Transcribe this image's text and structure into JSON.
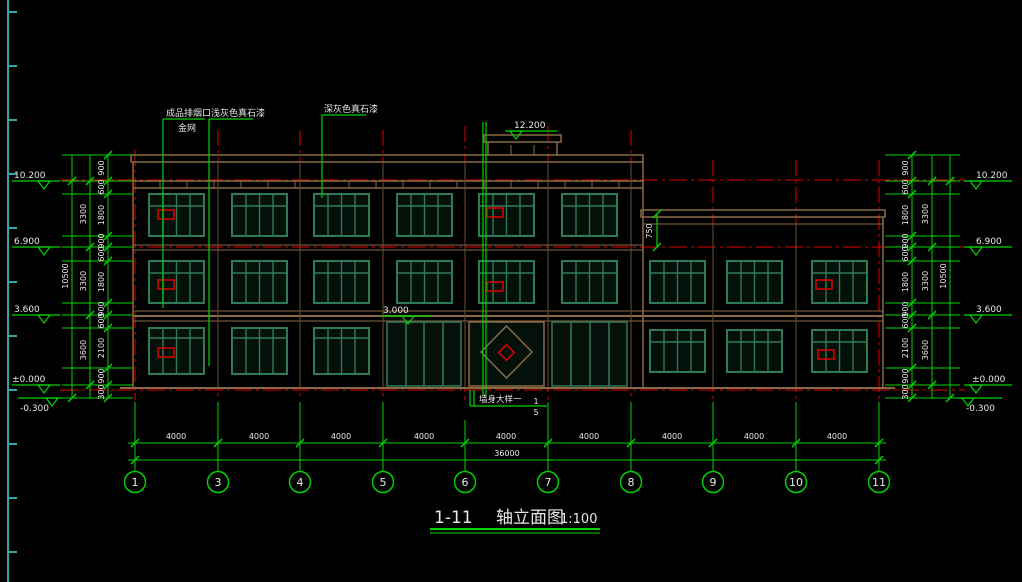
{
  "callouts": {
    "c1_line1": "成品排烟口",
    "c1_line2": "金网",
    "c2": "浅灰色真石漆",
    "c3": "深灰色真石漆"
  },
  "markers": {
    "bulkhead_top": "12.200",
    "canopy": "3.000",
    "levels": [
      "10.200",
      "6.900",
      "3.600",
      "±0.000",
      "-0.300"
    ]
  },
  "dims": {
    "inner": [
      "900",
      "600",
      "1800",
      "900",
      "600",
      "1800",
      "900",
      "600",
      "2100",
      "900",
      "300"
    ],
    "mid": [
      "3300",
      "3300",
      "3600"
    ],
    "total": "10500",
    "wing_parapet": "750"
  },
  "axis_dims": {
    "bays": [
      "4000",
      "4000",
      "4000",
      "4000",
      "4000",
      "4000",
      "4000",
      "4000",
      "4000"
    ],
    "total": "36000"
  },
  "axes": [
    "1",
    "3",
    "4",
    "5",
    "6",
    "7",
    "8",
    "9",
    "10",
    "11"
  ],
  "detail": {
    "label": "墙身大样一",
    "bubble_top": "1",
    "bubble_bottom": "5"
  },
  "title": {
    "axis_range": "1-11",
    "name": "轴立面图",
    "scale": "1:100"
  },
  "colors": {
    "dim_green": "#00d300",
    "axis_red": "#e00000",
    "wall_tan": "#8a6a45",
    "window_teal": "#2f7a58",
    "ruler_cyan": "#2fa8a8"
  }
}
